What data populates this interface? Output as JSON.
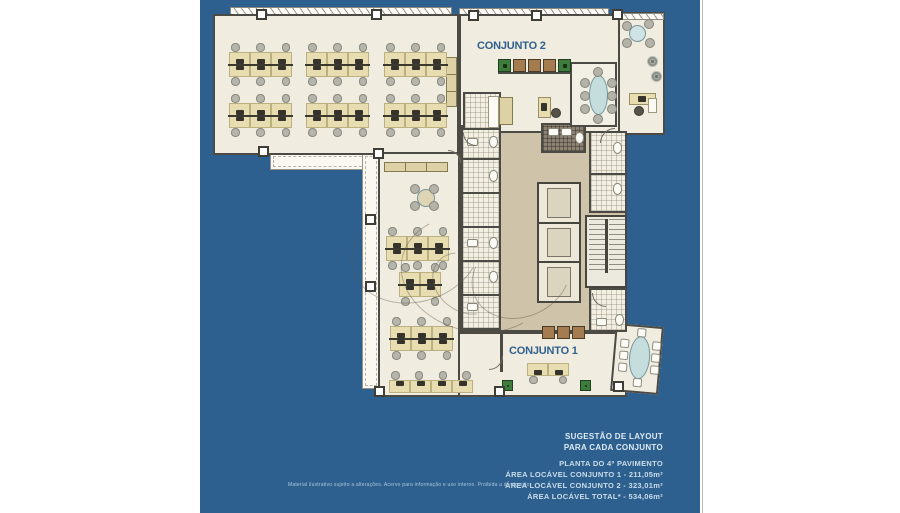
{
  "page": {
    "background": "#ffffff",
    "panel_color": "#2e608f",
    "edge_line_color": "#b7babc"
  },
  "plan": {
    "conjunto2_label": "CONJUNTO 2",
    "conjunto1_label": "CONJUNTO 1",
    "label_color": "#30608e",
    "colors": {
      "floor_cream": "#f0ecdf",
      "corridor_tan": "#cfc4aa",
      "wall_dark": "#4c4a44",
      "desk_tan": "#e7ddb0",
      "chair_gray": "#b6b5ab",
      "meeting_table_blue": "#c5dddd",
      "cabinet_brown": "#a57c50",
      "cabinet_green": "#3e7c3e",
      "terrace_white": "#faf8f0"
    }
  },
  "footer": {
    "suggestion_line1": "SUGESTÃO DE LAYOUT",
    "suggestion_line2": "PARA CADA CONJUNTO",
    "plan_title": "PLANTA DO 4º PAVIMENTO",
    "area_conjunto1": "ÁREA LOCÁVEL CONJUNTO 1 - 211,05m²",
    "area_conjunto2": "ÁREA LOCÁVEL CONJUNTO 2 - 323,01m²",
    "area_total": "ÁREA LOCÁVEL TOTAL* - 534,06m²",
    "text_color": "#c9dde9"
  },
  "disclaimer": "Material ilustrativo sujeito a alterações. Acervo para informação e uso interno. Proibida a divulgação."
}
